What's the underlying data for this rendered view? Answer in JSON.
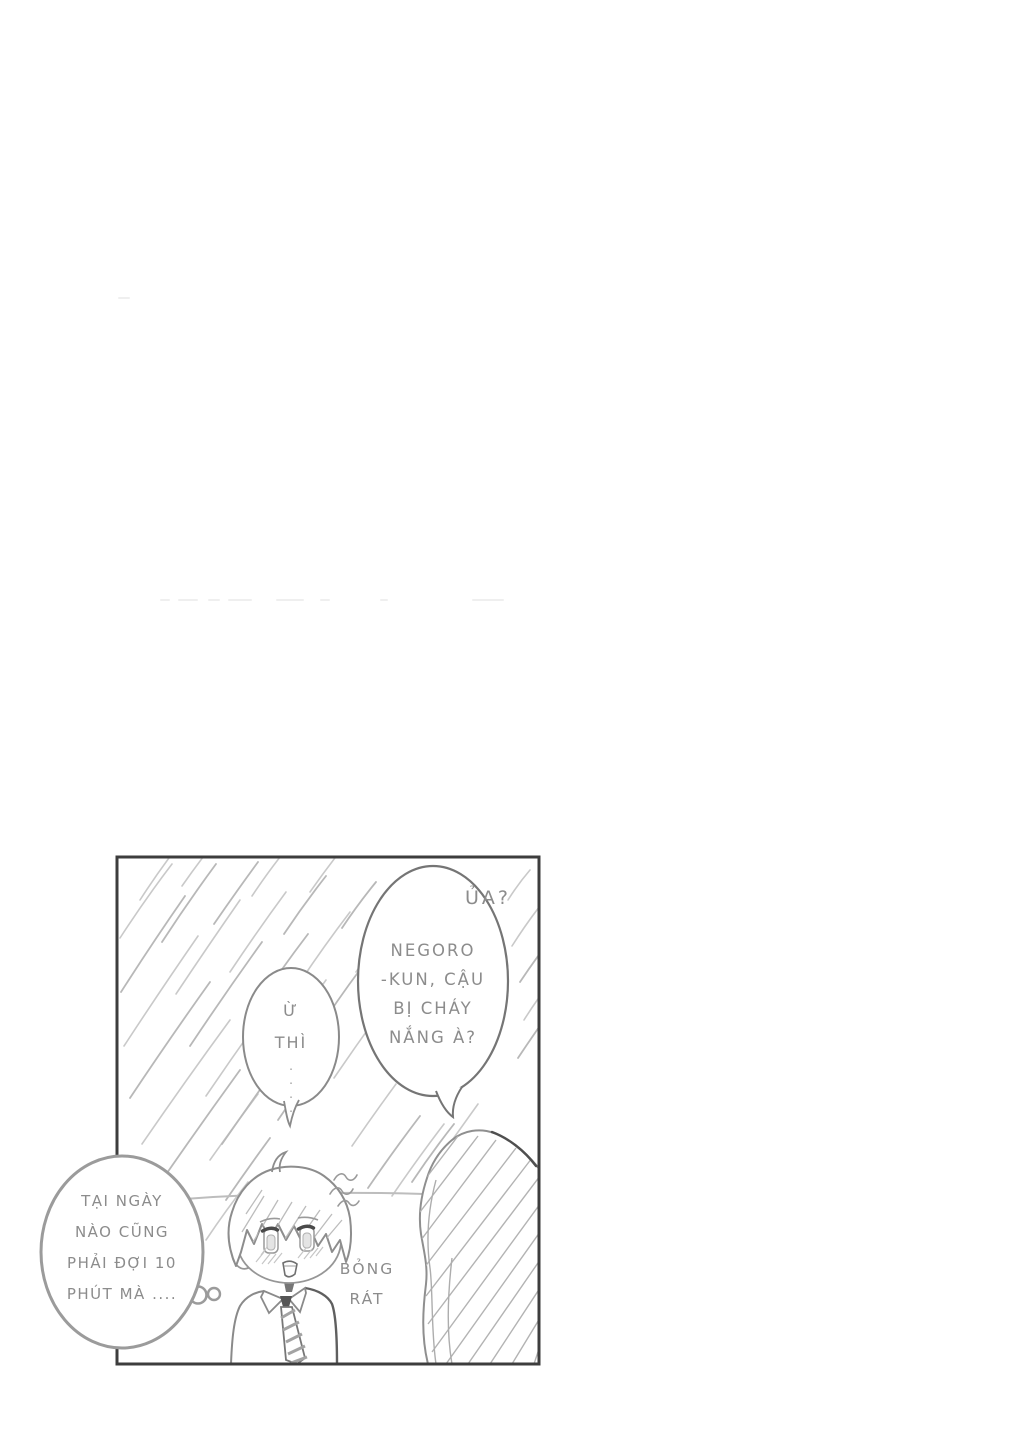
{
  "page": {
    "kind": "manga page",
    "background": "#ffffff"
  },
  "panel": {
    "border_color": "#3d3d3d"
  },
  "bubbles": {
    "girl": {
      "exclaim": "ỦA?",
      "lines": [
        "NEGORO",
        "-KUN, CẬU",
        "BỊ CHÁY",
        "NẮNG À?"
      ]
    },
    "boy": {
      "lines": [
        "Ừ",
        "THÌ"
      ],
      "ellipsis": "...."
    },
    "thought": {
      "lines": [
        "TẠI NGÀY",
        "NÀO CŨNG",
        "PHẢI ĐỢI 10",
        "PHÚT MÀ ...."
      ]
    }
  },
  "sfx": {
    "lines": [
      "BỎNG",
      "RÁT"
    ]
  },
  "colors": {
    "lettering": "#8c8c8c",
    "panel_border": "#3d3d3d",
    "line_art": "#8a8a8a",
    "speed_lines": "#c7c7c7"
  }
}
